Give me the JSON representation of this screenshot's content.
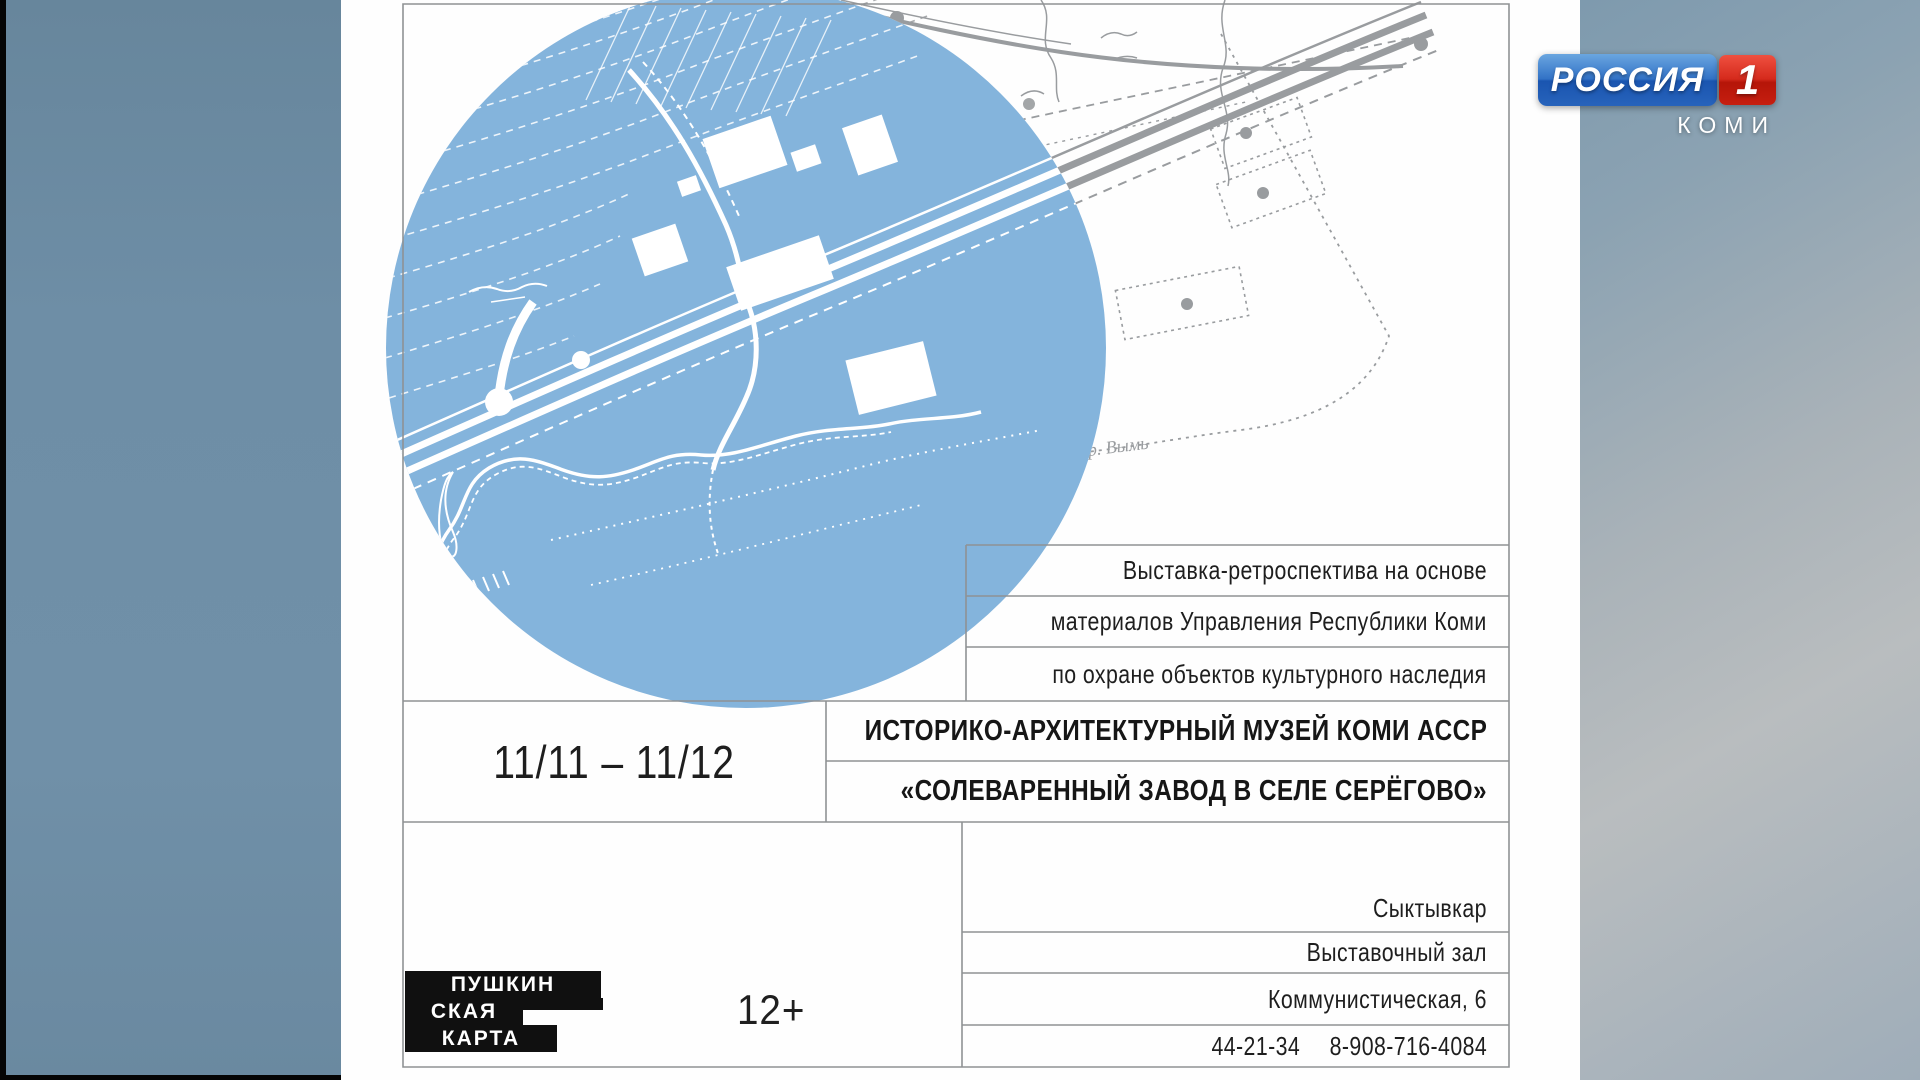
{
  "channel": {
    "name": "РОССИЯ",
    "number": "1",
    "region": "КОМИ"
  },
  "poster": {
    "info": {
      "line1": "Выставка-ретроспектива на основе",
      "line2": "материалов Управления Республики Коми",
      "line3": "по охране объектов культурного наследия"
    },
    "dates": "11/11 – 11/12",
    "museum": "ИСТОРИКО-АРХИТЕКТУРНЫЙ МУЗЕЙ КОМИ АССР",
    "exhibition": "«СОЛЕВАРЕННЫЙ ЗАВОД В СЕЛЕ СЕРЁГОВО»",
    "city": "Сыктывкар",
    "venue": "Выставочный зал",
    "address": "Коммунистическая, 6",
    "phone_local": "44-21-34",
    "phone_mobile": "8-908-716-4084",
    "age_rating": "12+",
    "pushkin_card": {
      "line1": "ПУШКИН",
      "line2": "СКАЯ",
      "line3": "КАРТА"
    },
    "map_label": "р. Вымь"
  },
  "colors": {
    "map_blue": "#84b4dc",
    "channel_blue": "#1c5fba",
    "channel_red": "#cf2318"
  }
}
